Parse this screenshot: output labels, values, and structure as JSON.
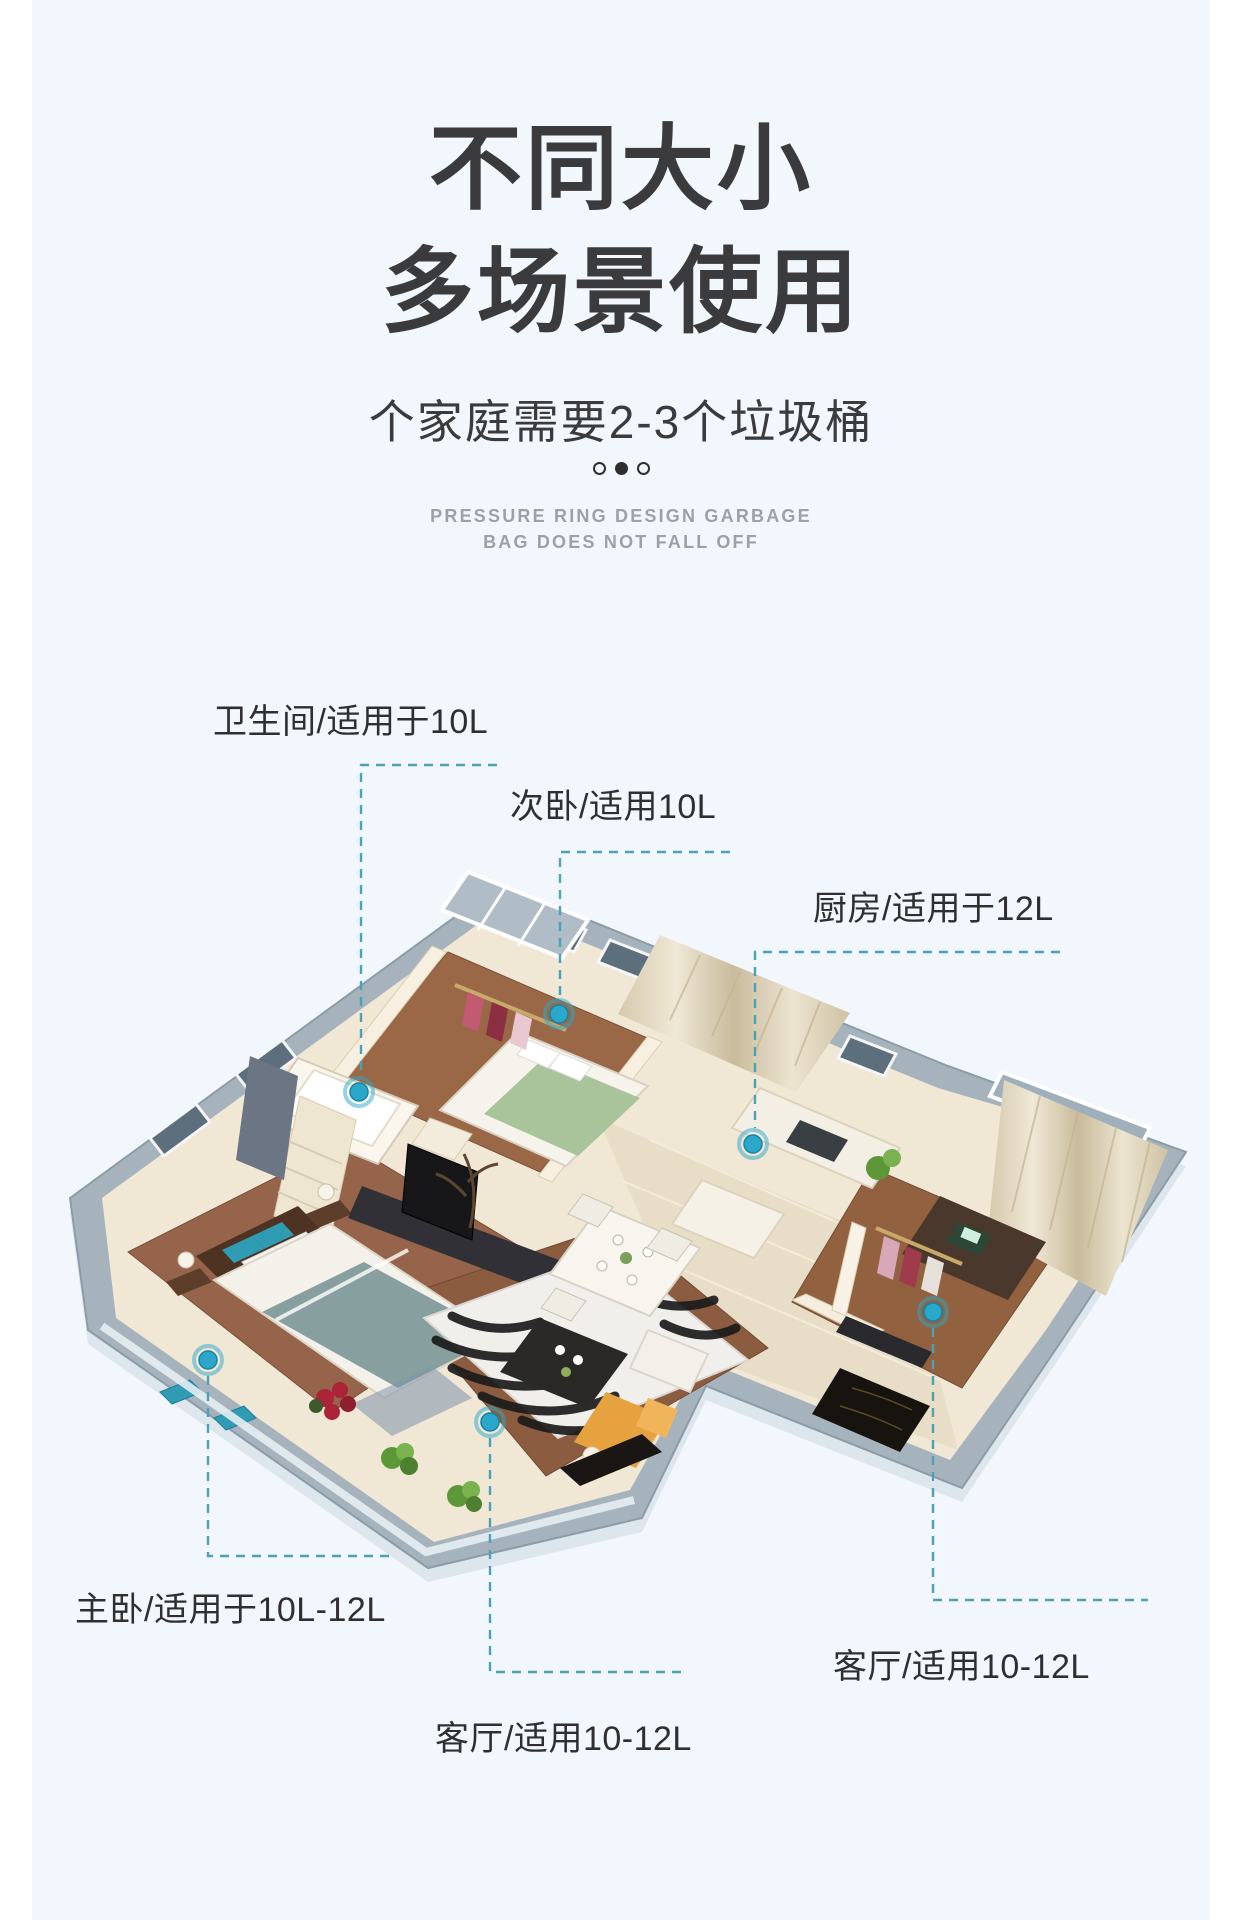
{
  "header": {
    "title_line1": "不同大小",
    "title_line2": "多场景使用",
    "subtitle": "个家庭需要2-3个垃圾桶"
  },
  "carousel": {
    "dot_count": 3,
    "active_index": 1
  },
  "caption": {
    "line1": "PRESSURE RING DESIGN GARBAGE",
    "line2": "BAG DOES NOT FALL OFF"
  },
  "callouts": [
    {
      "room": "bathroom",
      "text": "卫生间/适用于10L"
    },
    {
      "room": "second-bedroom",
      "text": "次卧/适用10L"
    },
    {
      "room": "kitchen",
      "text": "厨房/适用于12L"
    },
    {
      "room": "master-bedroom",
      "text": "主卧/适用于10L-12L"
    },
    {
      "room": "living-room",
      "text": "客厅/适用10-12L"
    },
    {
      "room": "living-room-2",
      "text": "客厅/适用10-12L"
    }
  ],
  "colors": {
    "content_background": "#f2f7fd",
    "title_text": "#3b3b3d",
    "caption_text": "#9ba1a9",
    "marker_accent": "#2ba7ca",
    "callout_line": "#4ba2b8"
  }
}
